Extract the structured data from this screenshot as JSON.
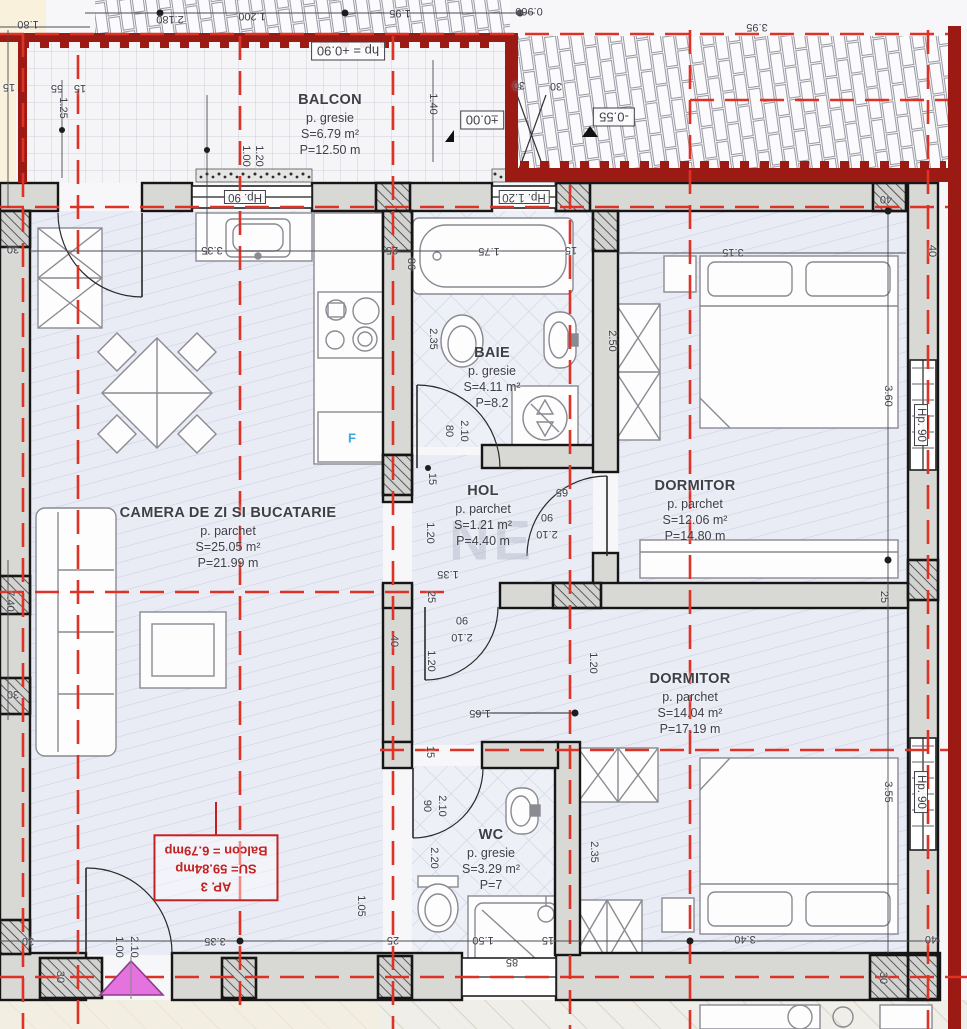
{
  "plan": {
    "apartment_tag": {
      "l1": "AP. 3",
      "l2": "SU= 59.84mp",
      "l3": "Balcon = 6.79mp"
    },
    "watermark": "NE",
    "rooms": [
      {
        "id": "balcon",
        "name": "BALCON",
        "finish": "p. gresie",
        "area": "S=6.79 m²",
        "perimeter": "P=12.50 m",
        "x": 330,
        "y": 125
      },
      {
        "id": "camera-de-zi",
        "name": "CAMERA DE ZI SI BUCATARIE",
        "finish": "p. parchet",
        "area": "S=25.05 m²",
        "perimeter": "P=21.99 m",
        "x": 228,
        "y": 538
      },
      {
        "id": "baie",
        "name": "BAIE",
        "finish": "p. gresie",
        "area": "S=4.11 m²",
        "perimeter": "P=8.2",
        "x": 492,
        "y": 378
      },
      {
        "id": "hol",
        "name": "HOL",
        "finish": "p. parchet",
        "area": "S=1.21 m²",
        "perimeter": "P=4.40 m",
        "x": 483,
        "y": 516
      },
      {
        "id": "dormitor-1",
        "name": "DORMITOR",
        "finish": "p. parchet",
        "area": "S=12.06 m²",
        "perimeter": "P=14.80 m",
        "x": 695,
        "y": 511
      },
      {
        "id": "dormitor-2",
        "name": "DORMITOR",
        "finish": "p. parchet",
        "area": "S=14.04 m²",
        "perimeter": "P=17.19 m",
        "x": 690,
        "y": 704
      },
      {
        "id": "wc",
        "name": "WC",
        "finish": "p. gresie",
        "area": "S=3.29 m²",
        "perimeter": "P=7",
        "x": 491,
        "y": 860
      }
    ],
    "levels": [
      {
        "t": "±0.00",
        "x": 482,
        "y": 120
      },
      {
        "t": "-0.55",
        "x": 614,
        "y": 117
      },
      {
        "t": "hp = +0.90",
        "x": 348,
        "y": 51
      }
    ],
    "dims": [
      {
        "t": "1.80",
        "x": 28,
        "y": 24,
        "r": 180
      },
      {
        "t": "2.180",
        "x": 170,
        "y": 19,
        "r": 180
      },
      {
        "t": "1.200",
        "x": 252,
        "y": 16,
        "r": 180
      },
      {
        "t": "1.95",
        "x": 400,
        "y": 13,
        "r": 180
      },
      {
        "t": "0.960",
        "x": 529,
        "y": 11,
        "r": 180
      },
      {
        "t": "3.95",
        "x": 757,
        "y": 27,
        "r": 180
      },
      {
        "t": "30",
        "x": 519,
        "y": 85,
        "r": 180
      },
      {
        "t": "30",
        "x": 556,
        "y": 86,
        "r": 180
      },
      {
        "t": "15",
        "x": 9,
        "y": 87,
        "r": 180
      },
      {
        "t": "55",
        "x": 57,
        "y": 88,
        "r": 180
      },
      {
        "t": "15",
        "x": 80,
        "y": 88,
        "r": 180
      },
      {
        "t": "1.25",
        "x": 63,
        "y": 108,
        "r": 90
      },
      {
        "t": "1.00",
        "x": 246,
        "y": 156,
        "r": 90
      },
      {
        "t": "1.20",
        "x": 259,
        "y": 156,
        "r": 90
      },
      {
        "t": "1.40",
        "x": 433,
        "y": 104,
        "r": 90
      },
      {
        "t": "30",
        "x": 13,
        "y": 249,
        "r": 180
      },
      {
        "t": "7.40",
        "x": 10,
        "y": 601,
        "r": 90
      },
      {
        "t": "30",
        "x": 13,
        "y": 694,
        "r": 180
      },
      {
        "t": "Hp. 90",
        "x": 245,
        "y": 197,
        "r": 180,
        "b": 1
      },
      {
        "t": "Hp. 1.20",
        "x": 524,
        "y": 197,
        "r": 180,
        "b": 1
      },
      {
        "t": "3.35",
        "x": 212,
        "y": 250,
        "r": 180
      },
      {
        "t": "25",
        "x": 392,
        "y": 250,
        "r": 180
      },
      {
        "t": "86",
        "x": 411,
        "y": 264,
        "r": 90
      },
      {
        "t": "1.75",
        "x": 489,
        "y": 251,
        "r": 180
      },
      {
        "t": "15",
        "x": 571,
        "y": 250,
        "r": 180
      },
      {
        "t": "3.15",
        "x": 733,
        "y": 252,
        "r": 180
      },
      {
        "t": "40",
        "x": 886,
        "y": 199,
        "r": 180
      },
      {
        "t": "40",
        "x": 932,
        "y": 251,
        "r": 90
      },
      {
        "t": "2.35",
        "x": 433,
        "y": 339,
        "r": 90
      },
      {
        "t": "2.50",
        "x": 612,
        "y": 341,
        "r": 90
      },
      {
        "t": "3.60",
        "x": 888,
        "y": 396,
        "r": 90
      },
      {
        "t": "Hp. 90",
        "x": 921,
        "y": 425,
        "r": 90,
        "b": 1
      },
      {
        "t": "80",
        "x": 449,
        "y": 431,
        "r": 90
      },
      {
        "t": "2.10",
        "x": 464,
        "y": 431,
        "r": 90
      },
      {
        "t": "15",
        "x": 432,
        "y": 479,
        "r": 90
      },
      {
        "t": "65",
        "x": 562,
        "y": 492,
        "r": 180
      },
      {
        "t": "90",
        "x": 547,
        "y": 517,
        "r": 180
      },
      {
        "t": "2.10",
        "x": 547,
        "y": 534,
        "r": 180
      },
      {
        "t": "1.20",
        "x": 430,
        "y": 533,
        "r": 90
      },
      {
        "t": "1.35",
        "x": 448,
        "y": 574,
        "r": 180
      },
      {
        "t": "25",
        "x": 431,
        "y": 597,
        "r": 90
      },
      {
        "t": "90",
        "x": 462,
        "y": 620,
        "r": 180
      },
      {
        "t": "2.10",
        "x": 462,
        "y": 637,
        "r": 180
      },
      {
        "t": "40",
        "x": 394,
        "y": 641,
        "r": 90
      },
      {
        "t": "1.20",
        "x": 431,
        "y": 661,
        "r": 90
      },
      {
        "t": "1.20",
        "x": 593,
        "y": 663,
        "r": 90
      },
      {
        "t": "25",
        "x": 884,
        "y": 597,
        "r": 90
      },
      {
        "t": "1.65",
        "x": 480,
        "y": 713,
        "r": 180
      },
      {
        "t": "15",
        "x": 430,
        "y": 752,
        "r": 90
      },
      {
        "t": "90",
        "x": 427,
        "y": 806,
        "r": 90
      },
      {
        "t": "2.10",
        "x": 442,
        "y": 806,
        "r": 90
      },
      {
        "t": "2.20",
        "x": 434,
        "y": 858,
        "r": 90
      },
      {
        "t": "2.35",
        "x": 594,
        "y": 852,
        "r": 90
      },
      {
        "t": "3.55",
        "x": 888,
        "y": 792,
        "r": 90
      },
      {
        "t": "Hp. 90",
        "x": 921,
        "y": 792,
        "r": 90,
        "b": 1
      },
      {
        "t": "1.05",
        "x": 361,
        "y": 906,
        "r": 90
      },
      {
        "t": "30",
        "x": 28,
        "y": 941,
        "r": 180
      },
      {
        "t": "3.35",
        "x": 215,
        "y": 941,
        "r": 180
      },
      {
        "t": "25",
        "x": 393,
        "y": 940,
        "r": 180
      },
      {
        "t": "1.50",
        "x": 483,
        "y": 940,
        "r": 180
      },
      {
        "t": "15",
        "x": 548,
        "y": 940,
        "r": 180
      },
      {
        "t": "3.40",
        "x": 745,
        "y": 939,
        "r": 180
      },
      {
        "t": "40",
        "x": 931,
        "y": 939,
        "r": 180
      },
      {
        "t": "85",
        "x": 512,
        "y": 962,
        "r": 180
      },
      {
        "t": "30",
        "x": 60,
        "y": 977,
        "r": 90
      },
      {
        "t": "30",
        "x": 883,
        "y": 978,
        "r": 90
      },
      {
        "t": "1.00",
        "x": 119,
        "y": 947,
        "r": 90
      },
      {
        "t": "2.10",
        "x": 134,
        "y": 947,
        "r": 90
      },
      {
        "t": "F",
        "x": 352,
        "y": 438,
        "r": 0,
        "c": "#3aa7dc"
      }
    ]
  }
}
